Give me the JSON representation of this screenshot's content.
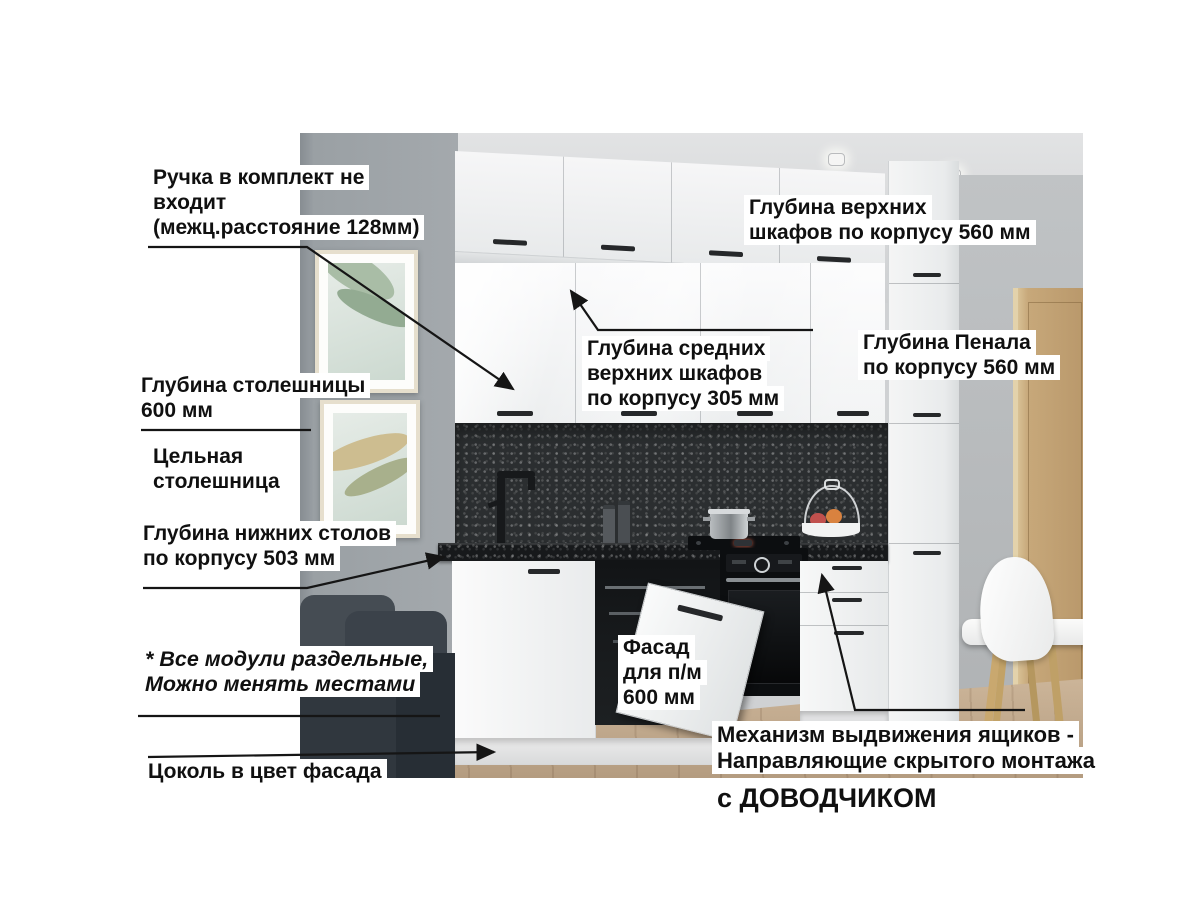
{
  "annotations": {
    "handle_note": "Ручка в комплект не\nвходит\n(межц.расстояние 128мм)",
    "upper_depth": "Глубина верхних\nшкафов по корпусу 560 мм",
    "middle_depth": "Глубина средних\nверхних шкафов\nпо корпусу 305 мм",
    "penal_depth": "Глубина Пенала\nпо корпусу 560 мм",
    "countertop_depth": "Глубина столешницы\n600 мм",
    "solid_countertop": "Цельная\nстолешница",
    "lower_depth": "Глубина нижних столов\nпо корпусу 503 мм",
    "modules_note": "* Все модули раздельные,\nМожно менять местами",
    "plinth_note": "Цоколь в цвет фасада",
    "dishwasher_facade": "Фасад\nдля п/м\n600 мм",
    "drawer_mechanism": "Механизм выдвижения ящиков -\nНаправляющие скрытого монтажа",
    "soft_close": "с ДОВОДЧИКОМ"
  },
  "colors": {
    "page_bg": "#ffffff",
    "label_bg": "#ffffff",
    "label_text": "#101010",
    "leader_line": "#151515",
    "cabinet_white": "#f3f4f4",
    "backsplash_dark": "#2b2e30",
    "countertop_dark": "#17191b",
    "wall_left_grey": "#9aa0a4",
    "wall_right_grey": "#b5b8ba",
    "ceiling_grey": "#dcdddf",
    "door_wood": "#bd9c6e",
    "floor_wood": "#c3ab90",
    "sofa_dark": "#3c434a",
    "appliance_black": "#101214"
  }
}
